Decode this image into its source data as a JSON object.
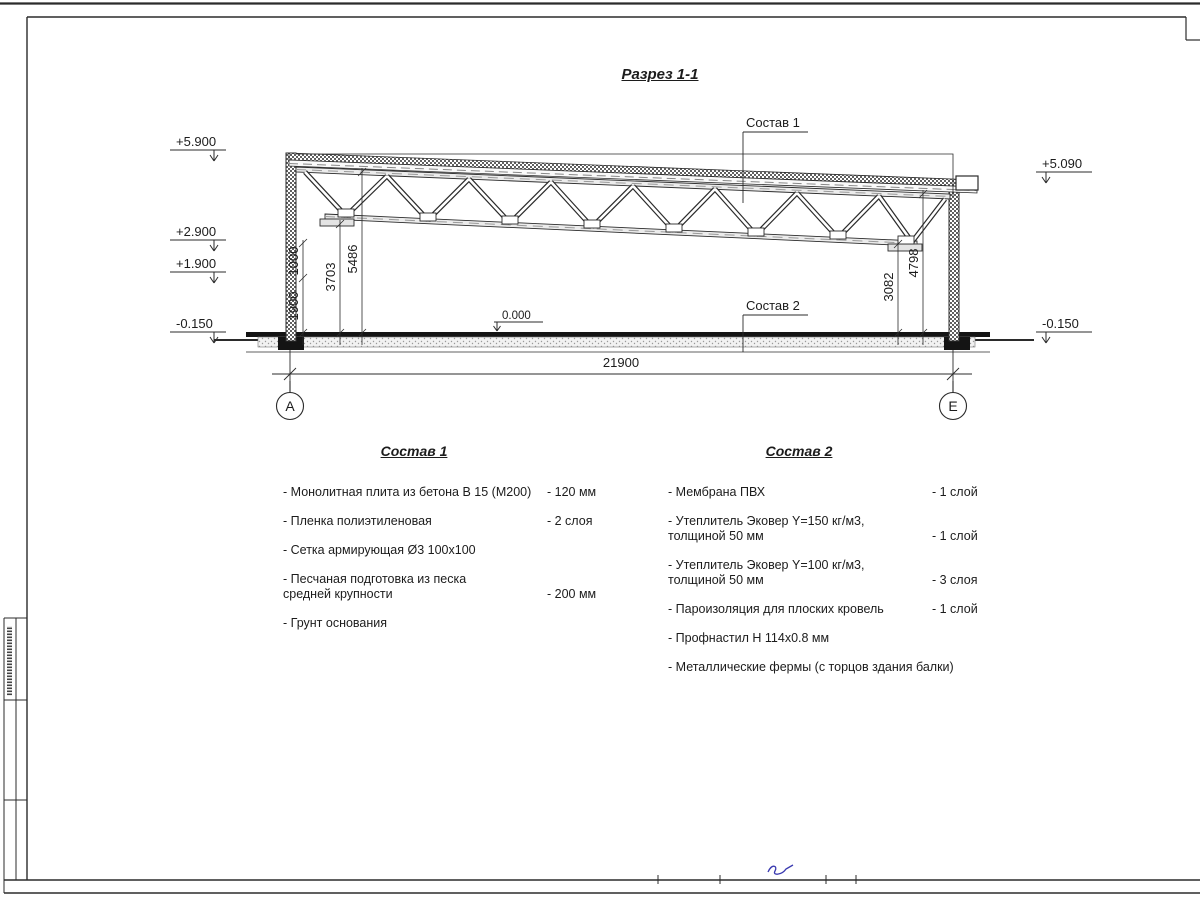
{
  "page": {
    "title": "Разрез 1-1"
  },
  "section": {
    "callout_roof": "Состав 1",
    "callout_floor": "Состав 2",
    "elevations": {
      "left_top": "+5.900",
      "left_mid1": "+2.900",
      "left_mid2": "+1.900",
      "left_bottom": "-0.150",
      "right_top": "+5.090",
      "right_bottom": "-0.150",
      "floor": "0.000"
    },
    "dims": {
      "d1000": "1000",
      "d1900": "1900",
      "d3703": "3703",
      "d5486": "5486",
      "d3082": "3082",
      "d4798": "4798",
      "span": "21900"
    },
    "axes": {
      "left": "А",
      "right": "Е"
    }
  },
  "legend1": {
    "heading": "Состав 1",
    "items": [
      {
        "line1": "- Монолитная плита из бетона В 15 (М200)",
        "line2": "",
        "value": "- 120 мм"
      },
      {
        "line1": "- Пленка полиэтиленовая",
        "line2": "",
        "value": "- 2 слоя"
      },
      {
        "line1": "- Сетка армирующая Ø3 100х100",
        "line2": "",
        "value": ""
      },
      {
        "line1": "- Песчаная подготовка из песка",
        "line2": "средней крупности",
        "value": "- 200 мм"
      },
      {
        "line1": "- Грунт основания",
        "line2": "",
        "value": ""
      }
    ]
  },
  "legend2": {
    "heading": "Состав 2",
    "items": [
      {
        "line1": "- Мембрана ПВХ",
        "line2": "",
        "value": "- 1 слой"
      },
      {
        "line1": "- Утеплитель Эковер Y=150 кг/м3,",
        "line2": "толщиной 50 мм",
        "value": "- 1 слой"
      },
      {
        "line1": "- Утеплитель Эковер Y=100 кг/м3,",
        "line2": "толщиной 50 мм",
        "value": "- 3 слоя"
      },
      {
        "line1": "- Пароизоляция для плоских кровель",
        "line2": "",
        "value": "- 1 слой"
      },
      {
        "line1": "- Профнастил Н 114х0.8 мм",
        "line2": "",
        "value": ""
      },
      {
        "line1": "- Металлические фермы (с торцов здания балки)",
        "line2": "",
        "value": ""
      }
    ]
  }
}
